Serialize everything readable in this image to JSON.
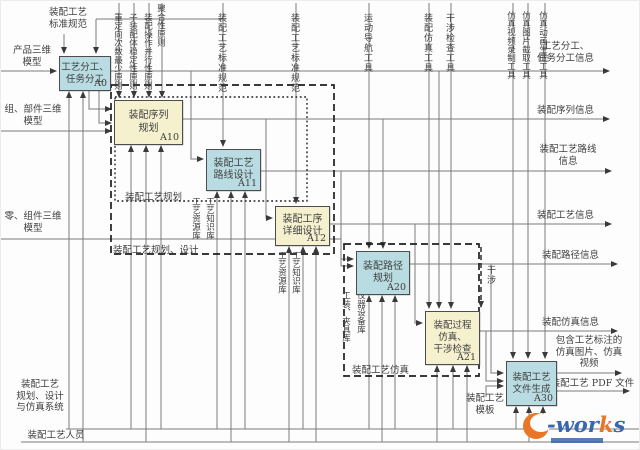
{
  "colors": {
    "box_blue": "#b9dce2",
    "box_yellow": "#f5f1cf",
    "line": "#7a7a7a",
    "dash": "#1f1f1f",
    "text": "#3f3f3f",
    "logo_orange": "#e87624",
    "logo_blue": "#3a66ad"
  },
  "top_left_control": {
    "lines": [
      "装配工艺",
      "标准规范"
    ]
  },
  "top_controls": [
    {
      "text": "装配工艺标准规范"
    },
    {
      "text": "装配工艺标准规范"
    },
    {
      "text": "运动导航工具"
    },
    {
      "text": "装配仿真工具"
    },
    {
      "text": "干涉检查工具"
    },
    {
      "text": "仿真视频录制工具"
    },
    {
      "text": "仿真图片截取工具"
    },
    {
      "text": "仿真动画生成工具"
    }
  ],
  "principles": [
    {
      "text": "重定向次数最少原则"
    },
    {
      "text": "子装配体稳定性原则"
    },
    {
      "text": "装配操作并行性原则"
    },
    {
      "text": "聚合性原则"
    }
  ],
  "inputs": [
    {
      "lines": [
        "产品三维",
        "模型"
      ]
    },
    {
      "lines": [
        "组、部件三维",
        "模型"
      ]
    },
    {
      "lines": [
        "零、组件三维",
        "模型"
      ]
    }
  ],
  "outputs": [
    {
      "lines": [
        "工艺分工、",
        "任务分工信息"
      ]
    },
    {
      "lines": [
        "装配序列信息"
      ]
    },
    {
      "lines": [
        "装配工艺路线",
        "信息"
      ]
    },
    {
      "lines": [
        "装配工艺信息"
      ]
    },
    {
      "lines": [
        "装配路径信息"
      ]
    },
    {
      "lines": [
        "装配仿真信息"
      ]
    },
    {
      "lines": [
        "包含工艺标注的",
        "仿真图片、仿真",
        "视频"
      ]
    },
    {
      "lines": [
        "装配工艺 PDF 文件"
      ]
    }
  ],
  "nodes": {
    "a0": {
      "lines": [
        "工艺分工、",
        "任务分工"
      ],
      "id": "A0"
    },
    "a10": {
      "lines": [
        "装配序列",
        "规划"
      ],
      "id": "A10"
    },
    "a11": {
      "lines": [
        "装配工艺",
        "路线设计"
      ],
      "id": "A11"
    },
    "a12": {
      "lines": [
        "装配工序",
        "详细设计"
      ],
      "id": "A12"
    },
    "a20": {
      "lines": [
        "装配路径",
        "规划"
      ],
      "id": "A20"
    },
    "a21": {
      "lines": [
        "装配过程",
        "仿真、",
        "干涉检查"
      ],
      "id": "A21"
    },
    "a30": {
      "lines": [
        "装配工艺",
        "文件生成"
      ],
      "id": "A30"
    }
  },
  "groups": {
    "planning": "装配工艺规划",
    "planning_design": "装配工艺规划、设计",
    "simulation": "装配工艺仿真"
  },
  "mechanism_labels": [
    {
      "text": "工艺资源库"
    },
    {
      "text": "工艺知识库"
    },
    {
      "text": "工艺资源库"
    },
    {
      "text": "工艺知识库"
    },
    {
      "text": "工装、夹具库"
    },
    {
      "text": "仪器设备库"
    }
  ],
  "feedback_label": "干涉",
  "bottom": {
    "system_lines": [
      "装配工艺",
      "规划、设计",
      "与仿真系统"
    ],
    "person": "装配工艺人员",
    "template_lines": [
      "装配工艺",
      "模板"
    ]
  },
  "logo": {
    "text_wor": "wor",
    "text_k": "k",
    "text_s": "s"
  }
}
